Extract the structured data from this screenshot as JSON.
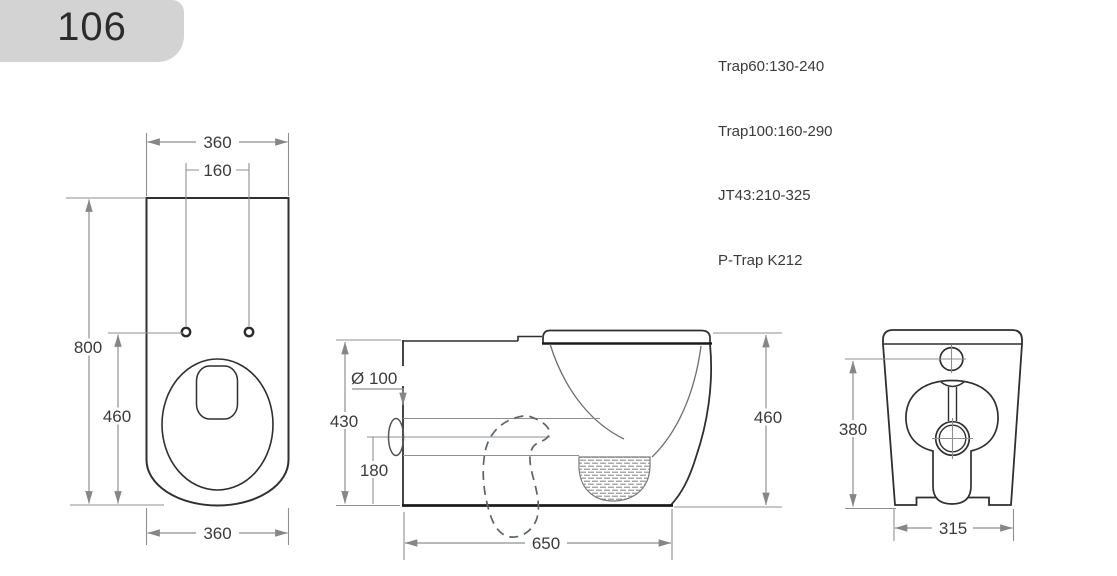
{
  "header": {
    "model_number": "106"
  },
  "trap_specs": {
    "line1": "Trap60:130-240",
    "line2": "Trap100:160-290",
    "line3": "JT43:210-325",
    "line4": "P-Trap K212"
  },
  "views": {
    "top_view": {
      "width_top": "360",
      "hole_spacing": "160",
      "overall_depth": "800",
      "bowl_depth": "460",
      "width_bottom": "360"
    },
    "side_view": {
      "outlet_diameter": "Ø 100",
      "back_height": "430",
      "outlet_center_height": "180",
      "overall_length": "650",
      "seat_height": "460"
    },
    "rear_view": {
      "inlet_height": "380",
      "base_width": "315"
    }
  },
  "colors": {
    "header_bg": "#d3d3d3",
    "object_line": "#2f2f2f",
    "thick_line": "#1b1b1b",
    "dimension_line": "#8a8a8a",
    "text": "#3b3b3b"
  }
}
